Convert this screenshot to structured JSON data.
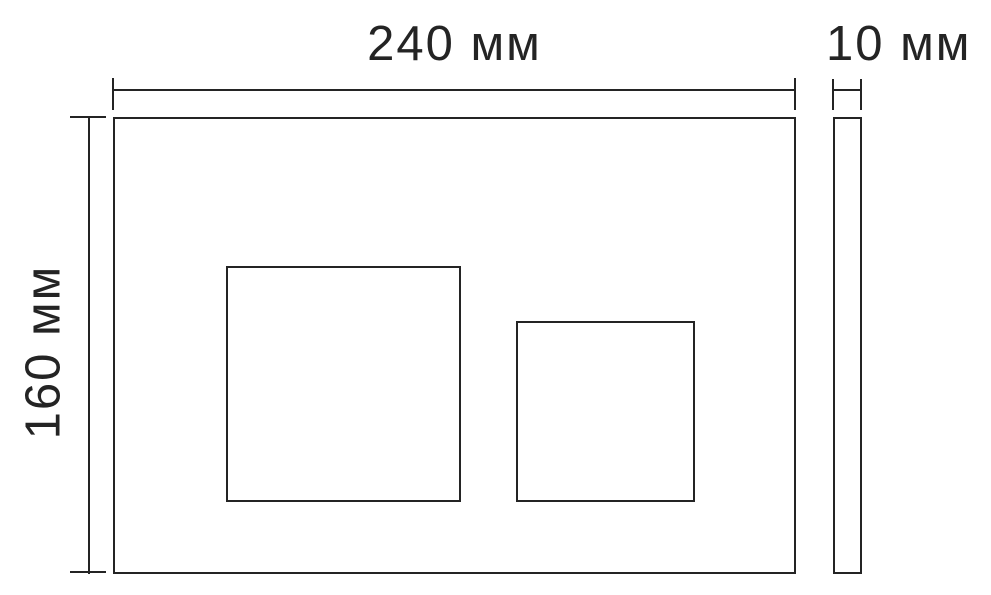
{
  "drawing": {
    "type": "technical-dimension-drawing",
    "subject": "wall flush plate with two buttons, front and side view",
    "colors": {
      "line": "#242424",
      "text": "#242424",
      "background": "#ffffff"
    },
    "dimensions": {
      "width": {
        "value": 240,
        "unit": "мм",
        "label": "240 мм"
      },
      "height": {
        "value": 160,
        "unit": "мм",
        "label": "160 мм"
      },
      "thickness": {
        "value": 10,
        "unit": "мм",
        "label": "10 мм"
      }
    }
  }
}
